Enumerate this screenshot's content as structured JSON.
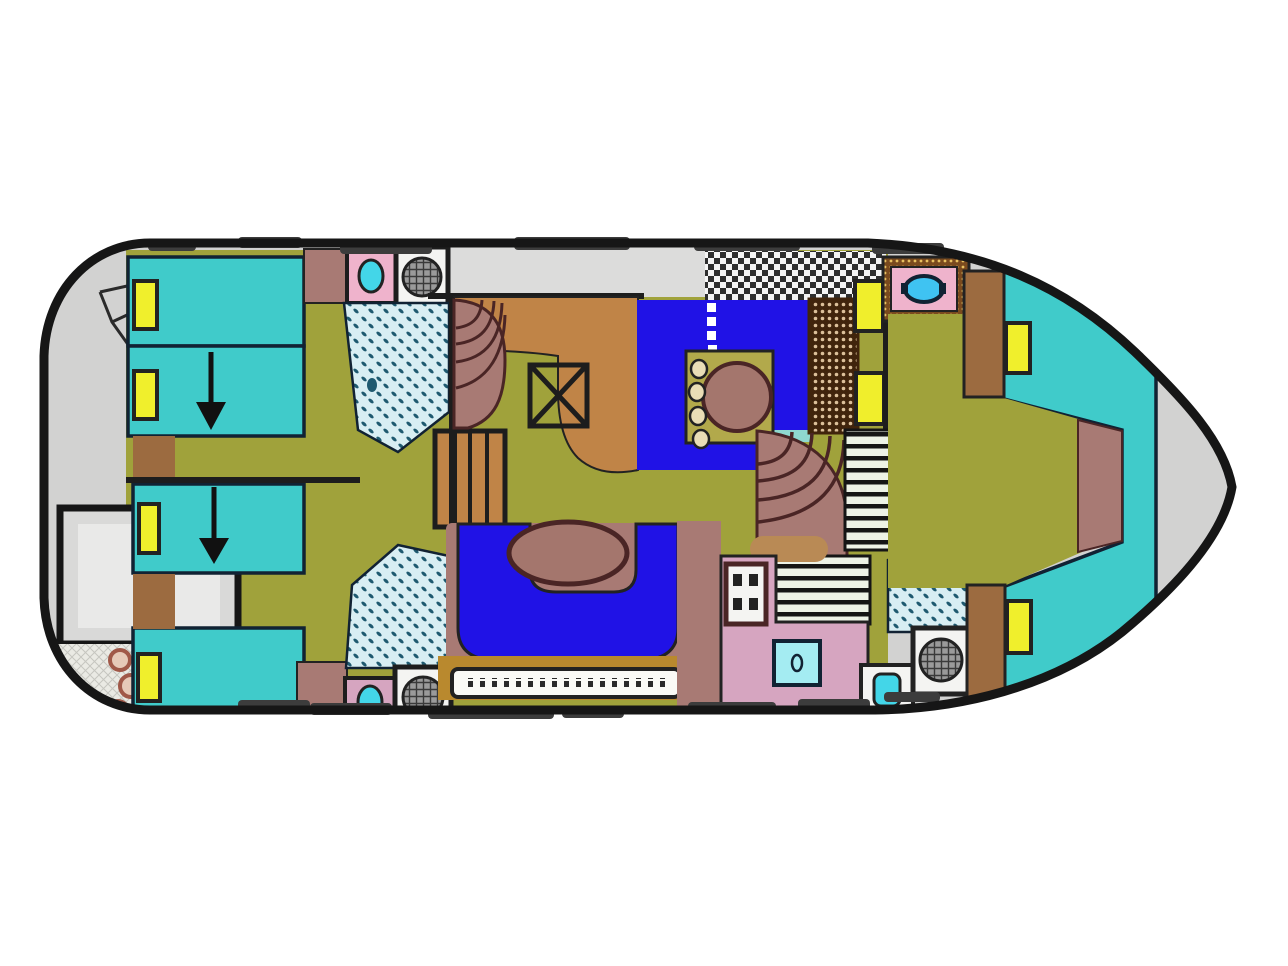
{
  "meta": {
    "type": "boat-floor-plan",
    "subject": "houseboat deck layout, bow pointing right",
    "berth_count": 6,
    "stair_arrow_count": 2
  },
  "rooms": [
    {
      "name": "aft-deck"
    },
    {
      "name": "aft-stairway"
    },
    {
      "name": "swim-platform"
    },
    {
      "name": "mooring-line-locker"
    },
    {
      "name": "port-aft-cabin"
    },
    {
      "name": "starboard-aft-cabin"
    },
    {
      "name": "port-head-with-shower"
    },
    {
      "name": "starboard-head-with-shower"
    },
    {
      "name": "galley"
    },
    {
      "name": "salon-dinette"
    },
    {
      "name": "salon-settee"
    },
    {
      "name": "helm-seat"
    },
    {
      "name": "midship-head"
    },
    {
      "name": "forward-head"
    },
    {
      "name": "forward-v-berth-cabin"
    },
    {
      "name": "bow-deck"
    }
  ],
  "colors": {
    "hull": "#161616",
    "deck": "#d2d2d1",
    "walkway": "#dcdcdb",
    "olive": "#a0a23b",
    "wall": "#1d1d1d",
    "berth": "#40cbca",
    "pillow": "#f0ef2c",
    "arrow": "#111111",
    "wardrobe": "#9c6b40",
    "mauve": "#a87a74",
    "pink": "#efb3cc",
    "pink2": "#d6a5c0",
    "counter": "#c08447",
    "ladder": "#c08447",
    "carpet": "#2012e6",
    "panel": "#b2a94b",
    "table": "#a4766d",
    "stool": "#e9ddb6",
    "teal_step": "#8fd8cf",
    "tan_step": "#b98a55",
    "cushion": "#f0ee2c",
    "rail": "#3c3c3c",
    "platform": "#d9d9d8",
    "platform_inner": "#e9e9e8",
    "rope": "#a05848",
    "rope_fill": "#e6c9b8",
    "rope_bg": "#eaeae4",
    "fixture": "#f4f4f2",
    "toilet_cyan": "#43d6e8",
    "tray_cyan": "#a4ecf2",
    "sink_blue": "#3fc3f2",
    "band_tan": "#b9892e",
    "slat": "#fafaf6",
    "stripe_bg": "#edf2e6",
    "stripe_line": "#151515",
    "shower_bg": "#d8eef3",
    "shower_dot": "#1f5a70",
    "checker_a": "#f4f4f4",
    "checker_b": "#2e2e2e",
    "helm_bg": "#40240c",
    "helm_dot": "#dcc09a",
    "gold_bg": "#7a4a1e",
    "gold_dot": "#e8c060",
    "hatch_a": "#9a9a9a",
    "hatch_b": "#3a3a3a",
    "sketch": "#2a2a2a",
    "dash_white": "#ffffff",
    "fan_arc": "#4a2525",
    "outline_dark": "#222222",
    "outline_navy": "#112233"
  }
}
